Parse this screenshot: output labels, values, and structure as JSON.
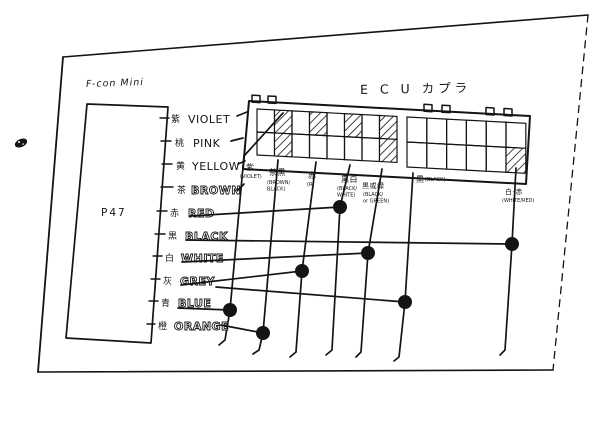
{
  "colors": {
    "ink": "#141414",
    "paper": "#ffffff"
  },
  "annotations": {
    "unit_name": "F-con Mini",
    "ecu_connector_title": "E C U カプラ",
    "unit_box_label": "P47"
  },
  "unit": {
    "box": [
      [
        87,
        104
      ],
      [
        168,
        107
      ],
      [
        151,
        343
      ],
      [
        66,
        338
      ]
    ],
    "wires": [
      {
        "kanji": "紫",
        "name": "VIOLET",
        "style": "plain",
        "y": 118,
        "kx": 171,
        "nx": 188,
        "tick": [
          [
            160,
            118
          ],
          [
            169,
            118
          ]
        ],
        "line": [
          [
            237,
            116
          ],
          [
            247,
            112
          ]
        ]
      },
      {
        "kanji": "桃",
        "name": "PINK",
        "style": "plain",
        "y": 142,
        "kx": 175,
        "nx": 193,
        "tick": [
          [
            161,
            141
          ],
          [
            171,
            141
          ]
        ],
        "line": [
          [
            231,
            141
          ],
          [
            243,
            138
          ]
        ]
      },
      {
        "kanji": "黄",
        "name": "YELLOW",
        "style": "plain",
        "y": 165,
        "kx": 176,
        "nx": 192,
        "tick": [
          [
            162,
            164
          ],
          [
            172,
            164
          ]
        ],
        "line": [
          [
            238,
            164
          ],
          [
            245,
            161
          ]
        ]
      },
      {
        "kanji": "茶",
        "name": "BROWN",
        "style": "outline",
        "y": 189,
        "kx": 177,
        "nx": 191,
        "tick": [
          [
            161,
            187
          ],
          [
            173,
            187
          ]
        ],
        "line": [
          [
            238,
            190
          ],
          [
            244,
            184
          ]
        ]
      },
      {
        "kanji": "赤",
        "name": "RED",
        "style": "outline",
        "y": 212,
        "kx": 170,
        "nx": 188,
        "tick": [
          [
            157,
            211
          ],
          [
            167,
            211
          ]
        ],
        "line": [
          [
            190,
            216
          ],
          [
            340,
            207
          ]
        ],
        "dot": [
          340,
          207
        ]
      },
      {
        "kanji": "黒",
        "name": "BLACK",
        "style": "outline",
        "y": 235,
        "kx": 168,
        "nx": 185,
        "tick": [
          [
            155,
            234
          ],
          [
            165,
            234
          ]
        ],
        "line": [
          [
            186,
            240
          ],
          [
            512,
            244
          ]
        ],
        "dot": [
          512,
          244
        ]
      },
      {
        "kanji": "白",
        "name": "WHITE",
        "style": "outline",
        "y": 257,
        "kx": 165,
        "nx": 181,
        "tick": [
          [
            153,
            256
          ],
          [
            162,
            256
          ]
        ],
        "line": [
          [
            182,
            262
          ],
          [
            368,
            253
          ]
        ],
        "dot": [
          368,
          253
        ]
      },
      {
        "kanji": "灰",
        "name": "GREY",
        "style": "outline",
        "y": 280,
        "kx": 163,
        "nx": 180,
        "tick": [
          [
            151,
            279
          ],
          [
            160,
            279
          ]
        ],
        "line": [
          [
            181,
            285
          ],
          [
            302,
            271
          ]
        ],
        "dot": [
          302,
          271
        ]
      },
      {
        "kanji": "青",
        "name": "BLUE",
        "style": "outline",
        "y": 302,
        "kx": 161,
        "nx": 178,
        "tick": [
          [
            149,
            301
          ],
          [
            158,
            301
          ]
        ],
        "line": [
          [
            216,
            287
          ],
          [
            405,
            302
          ]
        ],
        "dot": [
          405,
          302
        ],
        "line2": [
          [
            178,
            308
          ],
          [
            230,
            310
          ]
        ],
        "dot2": [
          230,
          310
        ]
      },
      {
        "kanji": "橙",
        "name": "ORANGE",
        "style": "outline",
        "y": 325,
        "kx": 158,
        "nx": 174,
        "tick": [
          [
            147,
            324
          ],
          [
            155,
            324
          ]
        ],
        "line": [
          [
            221,
            325
          ],
          [
            263,
            333
          ]
        ],
        "dot": [
          263,
          333
        ]
      }
    ]
  },
  "ecu": {
    "shell": [
      [
        249,
        101
      ],
      [
        530,
        116
      ],
      [
        526,
        184
      ],
      [
        243,
        169
      ]
    ],
    "slope": 0.053,
    "tabs": [
      252,
      268,
      424,
      442,
      486,
      504
    ],
    "tab_w": 8,
    "tab_h": 6,
    "blocks": [
      {
        "x": 257,
        "y": 109,
        "cols": 8,
        "rows": 2,
        "cw": 17.5,
        "ch": 23,
        "hatched": [
          [
            0,
            1
          ],
          [
            0,
            3
          ],
          [
            0,
            5
          ],
          [
            0,
            7
          ],
          [
            1,
            1
          ],
          [
            1,
            7
          ]
        ]
      },
      {
        "x": 407,
        "y": 117,
        "cols": 6,
        "rows": 2,
        "cw": 19.8,
        "ch": 25,
        "hatched": [
          [
            1,
            5
          ]
        ]
      }
    ],
    "pins": [
      {
        "label": "紫",
        "sub": [
          "(VIOLET)"
        ],
        "lx": 246,
        "ly": 170,
        "sx": 240,
        "sy": 178,
        "path": [
          [
            283,
            113
          ],
          [
            244,
            156
          ],
          [
            230,
            310
          ],
          [
            225,
            340
          ],
          [
            219,
            345
          ]
        ]
      },
      {
        "label": "茶黒",
        "sub": [
          "(BROWN/",
          "BLACK)"
        ],
        "lx": 269,
        "ly": 175,
        "sx": 267,
        "sy": 184,
        "path": [
          [
            278,
            160
          ],
          [
            263,
            333
          ],
          [
            259,
            350
          ],
          [
            253,
            354
          ]
        ]
      },
      {
        "label": "赤",
        "sub": [
          "(R)"
        ],
        "lx": 308,
        "ly": 178,
        "sx": 307,
        "sy": 186,
        "path": [
          [
            316,
            162
          ],
          [
            302,
            271
          ],
          [
            296,
            352
          ],
          [
            290,
            357
          ]
        ]
      },
      {
        "label": "黒白",
        "sub": [
          "(BLACK/",
          "WHITE)"
        ],
        "lx": 341,
        "ly": 182,
        "sx": 337,
        "sy": 190,
        "path": [
          [
            350,
            165
          ],
          [
            340,
            207
          ],
          [
            332,
            350
          ],
          [
            326,
            355
          ]
        ]
      },
      {
        "label": "黒或緑",
        "sub": [
          "(BLACK/",
          "or GREEN)"
        ],
        "lx": 362,
        "ly": 188,
        "sx": 363,
        "sy": 196,
        "path": [
          [
            382,
            169
          ],
          [
            368,
            253
          ],
          [
            361,
            352
          ],
          [
            356,
            357
          ]
        ]
      },
      {
        "label": "黒",
        "sub": [
          "(BLACK)"
        ],
        "lx": 416,
        "ly": 182,
        "sx": 425,
        "sy": 181,
        "path": [
          [
            413,
            173
          ],
          [
            405,
            302
          ],
          [
            399,
            357
          ],
          [
            394,
            361
          ]
        ]
      },
      {
        "label": "白-赤",
        "sub": [
          "(WHITE/RED)"
        ],
        "lx": 505,
        "ly": 194,
        "sx": 502,
        "sy": 202,
        "path": [
          [
            516,
            168
          ],
          [
            512,
            244
          ],
          [
            505,
            350
          ],
          [
            500,
            355
          ]
        ]
      }
    ]
  },
  "connections": [
    {
      "from": "RED",
      "to": "黒白"
    },
    {
      "from": "BLACK",
      "to": "白-赤"
    },
    {
      "from": "WHITE",
      "to": "黒或緑"
    },
    {
      "from": "GREY",
      "to": "赤"
    },
    {
      "from": "BLUE",
      "to": "黒"
    },
    {
      "from": "BLUE",
      "to": "紫"
    },
    {
      "from": "ORANGE",
      "to": "茶黒"
    }
  ],
  "border": {
    "top": [
      [
        63,
        57
      ],
      [
        588,
        15
      ]
    ],
    "left": [
      [
        63,
        57
      ],
      [
        38,
        372
      ]
    ],
    "bottom": [
      [
        38,
        372
      ],
      [
        553,
        370
      ]
    ],
    "right_dashed": [
      [
        588,
        15
      ],
      [
        553,
        370
      ]
    ]
  },
  "stamp": {
    "x": 21,
    "y": 143
  }
}
